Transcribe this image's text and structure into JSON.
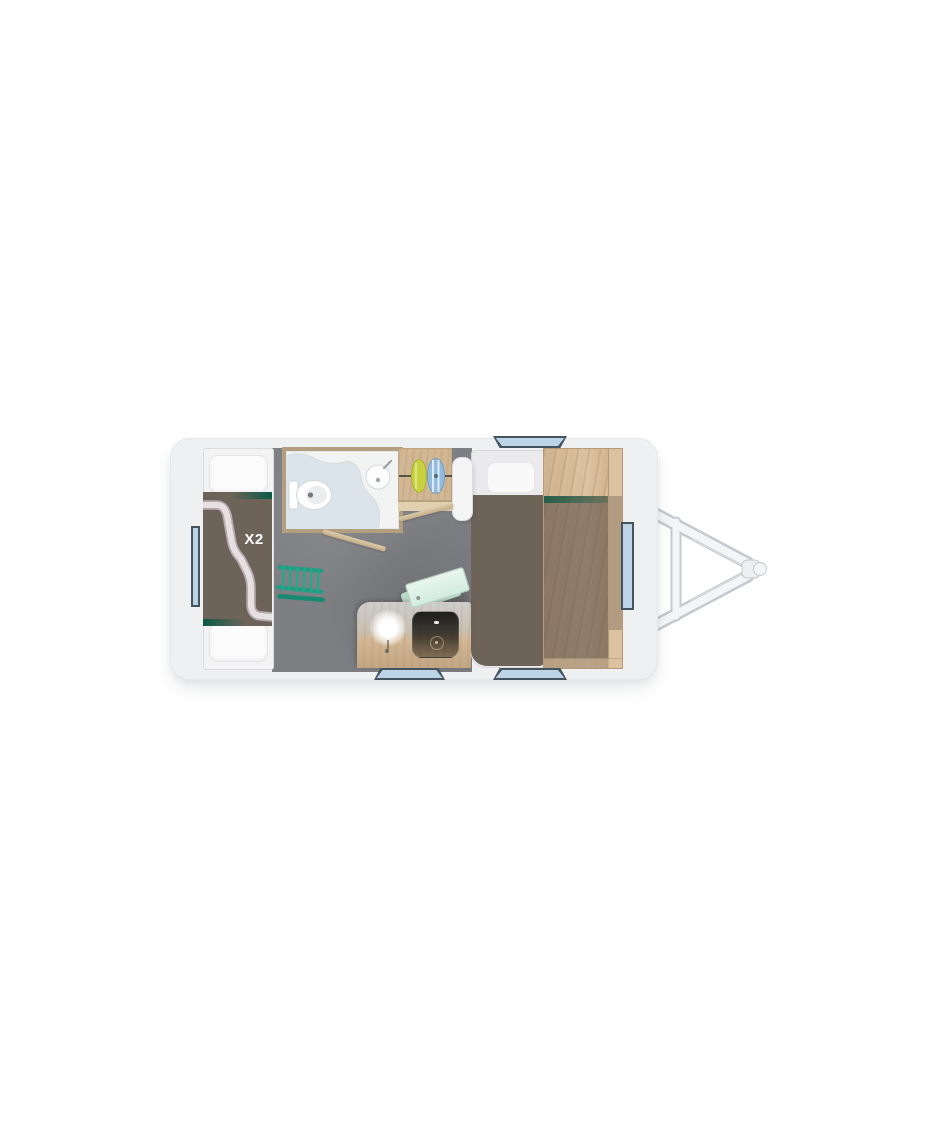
{
  "floorplan": {
    "bunk_label": "X2"
  },
  "colors": {
    "body": "#eef0f2",
    "floor": "#7e7f83",
    "blanket": "#6e6359",
    "mattress": "#f3f3f4",
    "bed_mattress": "#eaeaec",
    "pillow": "#fbfbfc",
    "accent_green": "#0b5b45",
    "ladder_teal": "#1f9c82",
    "ribbon": "#e8dfe2",
    "wood": "#d2b794",
    "marble": "#cfcecd",
    "bathroom_floor": "#dae4ea",
    "bathroom_wall": "#b49e80",
    "counter_white": "#f2f4f4",
    "window_blue": "#bdd3e6",
    "window_frame": "#46545f",
    "hob_black": "#232321",
    "table_mint": "#d3ecdf",
    "door_beige": "#c5ae89",
    "clothes_yellow": "#c8d23f",
    "clothes_blue": "#92bbdd",
    "hitch_fill": "#f4f5f7",
    "hitch_outline": "#c6c9cd"
  }
}
